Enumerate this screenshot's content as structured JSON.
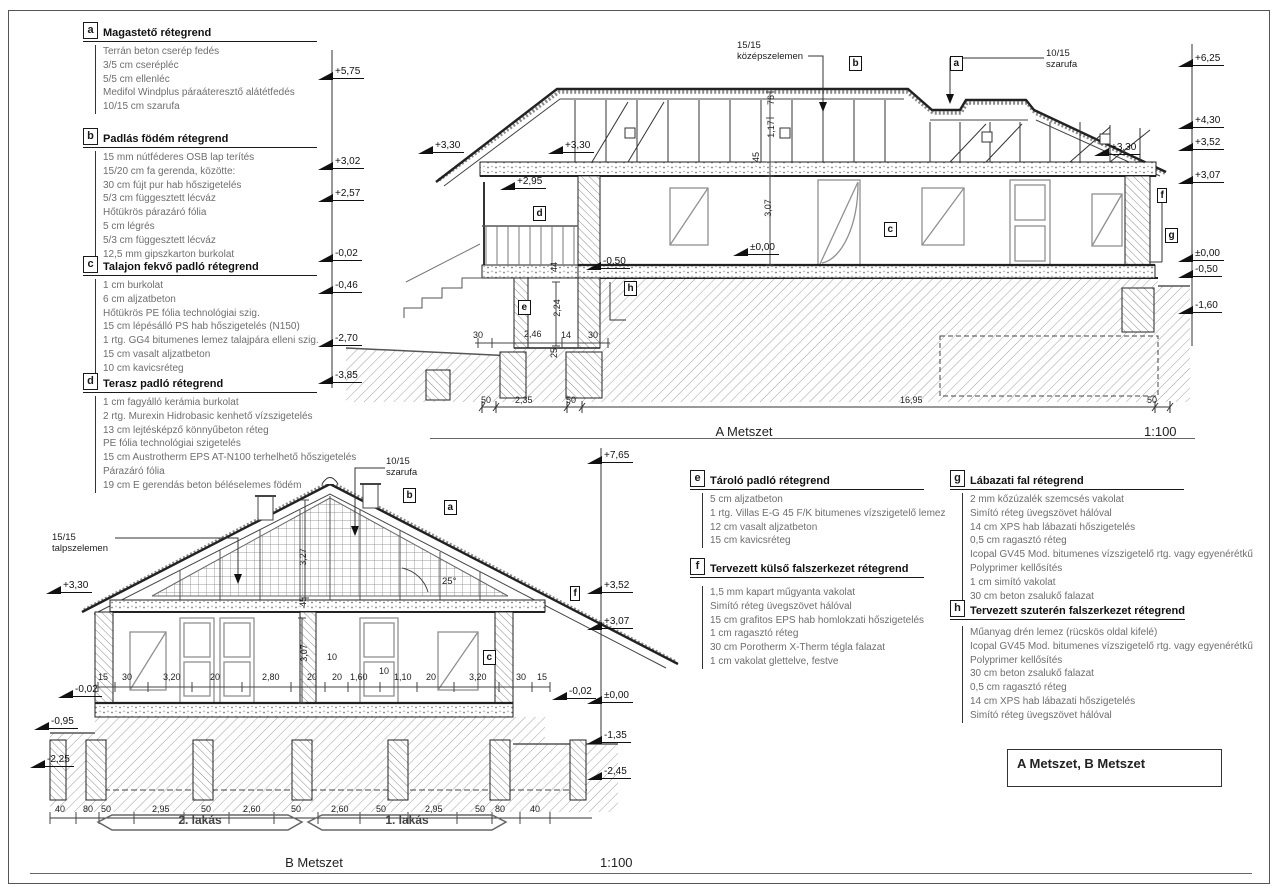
{
  "page": {
    "section_a_title": "A Metszet",
    "section_b_title": "B Metszet",
    "scale": "1:100",
    "title_box": "A Metszet, B Metszet"
  },
  "legends": [
    {
      "key": "a",
      "title": "Magastető rétegrend",
      "items": [
        "Terrán beton cserép fedés",
        "3/5 cm cserépléc",
        "5/5 cm ellenléc",
        "Medifol Windplus páraáteresztő alátétfedés",
        "10/15 cm szarufa"
      ]
    },
    {
      "key": "b",
      "title": "Padlás födém rétegrend",
      "items": [
        "15 mm nútféderes OSB lap terítés",
        "15/20 cm fa gerenda, közötte:",
        "30 cm fújt pur hab hőszigetelés",
        "5/3 cm függesztett lécváz",
        "Hőtükrös párazáró fólia",
        "5 cm légrés",
        "5/3 cm függesztett lécváz",
        "12,5 mm gipszkarton burkolat"
      ]
    },
    {
      "key": "c",
      "title": "Talajon fekvő padló rétegrend",
      "items": [
        "1 cm burkolat",
        "6 cm aljzatbeton",
        "Hőtükrös PE fólia technológiai szig.",
        "15 cm lépésálló PS hab hőszigetelés (N150)",
        "1 rtg. GG4 bitumenes lemez talajpára elleni szig.",
        "15 cm vasalt aljzatbeton",
        "10 cm kavicsréteg"
      ]
    },
    {
      "key": "d",
      "title": "Terasz padló rétegrend",
      "items": [
        "1 cm fagyálló kerámia burkolat",
        "2 rtg. Murexin Hidrobasic kenhető vízszigetelés",
        "13 cm lejtésképző könnyűbeton réteg",
        "PE fólia technológiai szigetelés",
        "15 cm Austrotherm EPS AT-N100 terhelhető hőszigetelés",
        "Párazáró fólia",
        "19 cm E gerendás beton béléselemes födém"
      ]
    },
    {
      "key": "e",
      "title": "Tároló padló rétegrend",
      "items": [
        "5 cm aljzatbeton",
        "1 rtg. Villas E-G 45 F/K bitumenes vízszigetelő lemez",
        "12 cm vasalt aljzatbeton",
        "15 cm kavicsréteg"
      ]
    },
    {
      "key": "f",
      "title": "Tervezett külső falszerkezet rétegrend",
      "items": [
        "1,5 mm kapart műgyanta vakolat",
        "Simító réteg üvegszövet hálóval",
        "15 cm grafitos EPS hab homlokzati hőszigetelés",
        "1 cm ragasztó réteg",
        "30 cm Porotherm X-Therm tégla falazat",
        "1 cm vakolat glettelve, festve"
      ]
    },
    {
      "key": "g",
      "title": "Lábazati fal rétegrend",
      "items": [
        "2 mm kőzúzalék szemcsés vakolat",
        "Simító réteg üvegszövet hálóval",
        "14 cm XPS hab lábazati hőszigetelés",
        "0,5 cm ragasztó réteg",
        "Icopal GV45 Mod. bitumenes vízszigetelő rtg. vagy egyenérétkű",
        "Polyprimer kellősítés",
        "1 cm simító vakolat",
        "30 cm beton zsalukő falazat"
      ]
    },
    {
      "key": "h",
      "title": "Tervezett szuterén falszerkezet rétegrend",
      "items": [
        "Műanyag drén lemez (rücskös oldal kifelé)",
        "Icopal GV45 Mod. bitumenes vízszigetelő rtg. vagy egyenérétkű",
        "Polyprimer kellősítés",
        "30 cm beton zsalukő falazat",
        "0,5 cm ragasztó réteg",
        "14 cm XPS hab lábazati hőszigetelés",
        "Simító réteg üvegszövet hálóval"
      ]
    }
  ],
  "section_a": {
    "levels_left": [
      {
        "t": "+5,75",
        "x": 318,
        "y": 66
      },
      {
        "t": "+3,02",
        "x": 318,
        "y": 156
      },
      {
        "t": "+2,57",
        "x": 318,
        "y": 188
      },
      {
        "t": "-0,02",
        "x": 318,
        "y": 248
      },
      {
        "t": "-0,46",
        "x": 318,
        "y": 280
      },
      {
        "t": "-2,70",
        "x": 318,
        "y": 333
      },
      {
        "t": "-3,85",
        "x": 318,
        "y": 370
      }
    ],
    "levels_right": [
      {
        "t": "+6,25",
        "x": 1178,
        "y": 53
      },
      {
        "t": "+4,30",
        "x": 1178,
        "y": 115
      },
      {
        "t": "+3,52",
        "x": 1178,
        "y": 137
      },
      {
        "t": "+3,07",
        "x": 1178,
        "y": 170
      },
      {
        "t": "±0,00",
        "x": 1178,
        "y": 248
      },
      {
        "t": "-0,50",
        "x": 1178,
        "y": 264
      },
      {
        "t": "-1,60",
        "x": 1178,
        "y": 300
      }
    ],
    "levels_inner": [
      {
        "t": "+3,30",
        "x": 418,
        "y": 140
      },
      {
        "t": "+3,30",
        "x": 548,
        "y": 140
      },
      {
        "t": "+2,95",
        "x": 500,
        "y": 176
      },
      {
        "t": "+3,30",
        "x": 1094,
        "y": 142
      },
      {
        "t": "±0,00",
        "x": 733,
        "y": 242
      },
      {
        "t": "-0,50",
        "x": 586,
        "y": 256
      }
    ],
    "dims": [
      {
        "t": "50",
        "x": 481,
        "y": 395
      },
      {
        "t": "2,35",
        "x": 515,
        "y": 395
      },
      {
        "t": "50",
        "x": 566,
        "y": 395
      },
      {
        "t": "16,95",
        "x": 900,
        "y": 395
      },
      {
        "t": "50",
        "x": 1147,
        "y": 395
      },
      {
        "t": "30",
        "x": 473,
        "y": 330
      },
      {
        "t": "2,46",
        "x": 524,
        "y": 329
      },
      {
        "t": "14",
        "x": 561,
        "y": 330
      },
      {
        "t": "30",
        "x": 588,
        "y": 330
      },
      {
        "t": "44",
        "x": 549,
        "y": 262,
        "r": 1
      },
      {
        "t": "2,24",
        "x": 548,
        "y": 303,
        "r": 1
      },
      {
        "t": "25",
        "x": 549,
        "y": 348,
        "r": 1
      },
      {
        "t": "76",
        "x": 766,
        "y": 95,
        "r": 1
      },
      {
        "t": "1,17",
        "x": 762,
        "y": 124,
        "r": 1
      },
      {
        "t": "45",
        "x": 751,
        "y": 152,
        "r": 1
      },
      {
        "t": "3,07",
        "x": 759,
        "y": 203,
        "r": 1
      }
    ],
    "notes": [
      {
        "t": "15/15\nközépszelemen",
        "x": 737,
        "y": 40
      },
      {
        "t": "10/15\nszarufa",
        "x": 1046,
        "y": 48
      }
    ],
    "marks": [
      {
        "t": "b",
        "x": 849,
        "y": 56
      },
      {
        "t": "a",
        "x": 950,
        "y": 56
      },
      {
        "t": "d",
        "x": 533,
        "y": 206
      },
      {
        "t": "e",
        "x": 518,
        "y": 300
      },
      {
        "t": "h",
        "x": 624,
        "y": 281
      },
      {
        "t": "c",
        "x": 884,
        "y": 222
      },
      {
        "t": "f",
        "x": 1157,
        "y": 188
      },
      {
        "t": "g",
        "x": 1165,
        "y": 228
      }
    ]
  },
  "section_b": {
    "levels_left": [
      {
        "t": "+3,30",
        "x": 46,
        "y": 580
      },
      {
        "t": "-0,02",
        "x": 58,
        "y": 684
      },
      {
        "t": "-0,95",
        "x": 34,
        "y": 716
      },
      {
        "t": "-2,25",
        "x": 30,
        "y": 754
      }
    ],
    "levels_right": [
      {
        "t": "+7,65",
        "x": 587,
        "y": 450
      },
      {
        "t": "+3,52",
        "x": 587,
        "y": 580
      },
      {
        "t": "+3,07",
        "x": 587,
        "y": 616
      },
      {
        "t": "±0,00",
        "x": 587,
        "y": 690
      },
      {
        "t": "-1,35",
        "x": 587,
        "y": 730
      },
      {
        "t": "-2,45",
        "x": 587,
        "y": 766
      }
    ],
    "levels_inner": [
      {
        "t": "-0,02",
        "x": 552,
        "y": 686
      }
    ],
    "dims": [
      {
        "t": "15",
        "x": 98,
        "y": 672
      },
      {
        "t": "30",
        "x": 122,
        "y": 672
      },
      {
        "t": "3,20",
        "x": 163,
        "y": 672
      },
      {
        "t": "20",
        "x": 210,
        "y": 672
      },
      {
        "t": "2,80",
        "x": 262,
        "y": 672
      },
      {
        "t": "20",
        "x": 307,
        "y": 672
      },
      {
        "t": "20",
        "x": 332,
        "y": 672
      },
      {
        "t": "1,60",
        "x": 350,
        "y": 672
      },
      {
        "t": "1,10",
        "x": 394,
        "y": 672
      },
      {
        "t": "20",
        "x": 426,
        "y": 672
      },
      {
        "t": "3,20",
        "x": 469,
        "y": 672
      },
      {
        "t": "30",
        "x": 516,
        "y": 672
      },
      {
        "t": "15",
        "x": 537,
        "y": 672
      },
      {
        "t": "10",
        "x": 327,
        "y": 652
      },
      {
        "t": "10",
        "x": 379,
        "y": 666
      },
      {
        "t": "3,07",
        "x": 295,
        "y": 648,
        "r": 1
      },
      {
        "t": "3,27",
        "x": 294,
        "y": 552,
        "r": 1
      },
      {
        "t": "45",
        "x": 298,
        "y": 597,
        "r": 1
      },
      {
        "t": "40",
        "x": 55,
        "y": 804
      },
      {
        "t": "80",
        "x": 83,
        "y": 804
      },
      {
        "t": "50",
        "x": 101,
        "y": 804
      },
      {
        "t": "2,95",
        "x": 152,
        "y": 804
      },
      {
        "t": "50",
        "x": 201,
        "y": 804
      },
      {
        "t": "2,60",
        "x": 243,
        "y": 804
      },
      {
        "t": "50",
        "x": 291,
        "y": 804
      },
      {
        "t": "2,60",
        "x": 331,
        "y": 804
      },
      {
        "t": "50",
        "x": 376,
        "y": 804
      },
      {
        "t": "2,95",
        "x": 425,
        "y": 804
      },
      {
        "t": "50",
        "x": 475,
        "y": 804
      },
      {
        "t": "80",
        "x": 495,
        "y": 804
      },
      {
        "t": "40",
        "x": 530,
        "y": 804
      }
    ],
    "notes": [
      {
        "t": "15/15\ntalpszelemen",
        "x": 52,
        "y": 532
      },
      {
        "t": "10/15\nszarufa",
        "x": 386,
        "y": 456
      },
      {
        "t": "25°",
        "x": 442,
        "y": 576
      }
    ],
    "marks": [
      {
        "t": "b",
        "x": 403,
        "y": 488
      },
      {
        "t": "a",
        "x": 444,
        "y": 500
      },
      {
        "t": "f",
        "x": 570,
        "y": 586
      },
      {
        "t": "c",
        "x": 483,
        "y": 650
      }
    ],
    "units": [
      {
        "t": "2. lakás",
        "x": 200,
        "y": 813
      },
      {
        "t": "1. lakás",
        "x": 407,
        "y": 813
      }
    ]
  }
}
